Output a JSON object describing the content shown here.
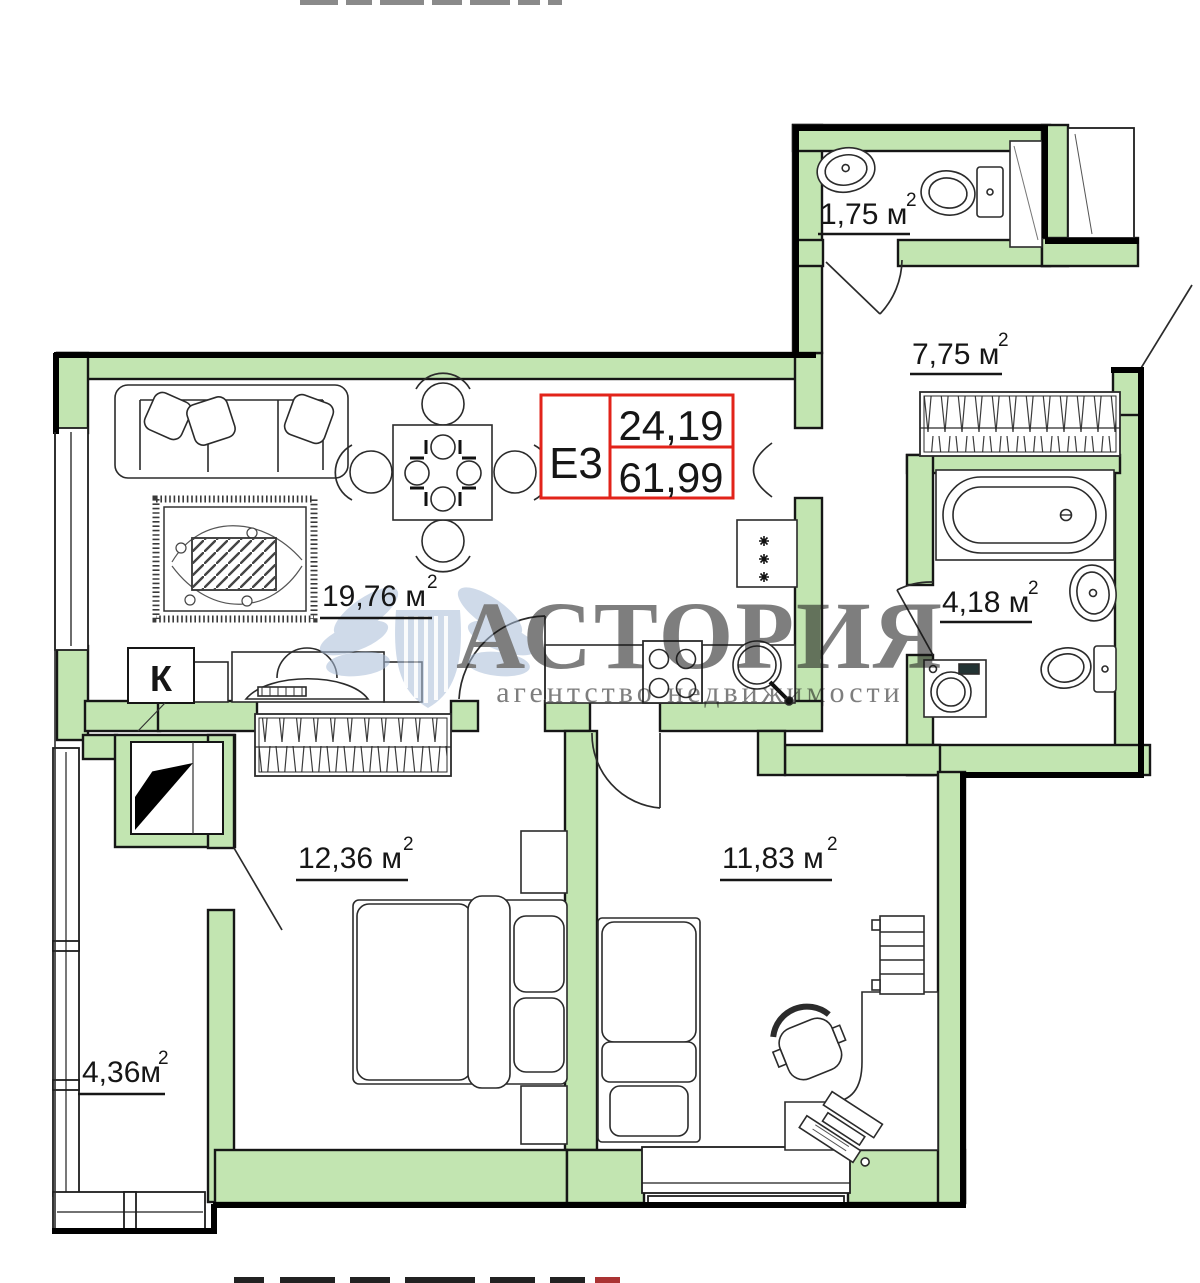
{
  "meta": {
    "area_superscript": "2"
  },
  "unit_badge": {
    "code": "Е3",
    "room_area": "24,19",
    "total_area": "61,99"
  },
  "rooms": {
    "wc": {
      "area": "1,75 м"
    },
    "hallway": {
      "area": "7,75 м"
    },
    "bathroom": {
      "area": "4,18 м"
    },
    "living_kitchen": {
      "area": "19,76 м"
    },
    "bedroom1": {
      "area": "12,36 м"
    },
    "bedroom2": {
      "area": "11,83 м"
    },
    "balcony": {
      "area": "4,36м"
    }
  },
  "labels": {
    "shaft": "К"
  },
  "watermark": {
    "title": "АСТОРИЯ",
    "subtitle": "агентство недвижимости"
  },
  "colors": {
    "wall_fill": "#c2e5b1",
    "outline": "#111111",
    "badge_red": "#e2231a",
    "watermark_title": "#dc7b7b",
    "watermark_subtitle": "#9db1cf",
    "watermark_logo": "#a9bdd8"
  }
}
